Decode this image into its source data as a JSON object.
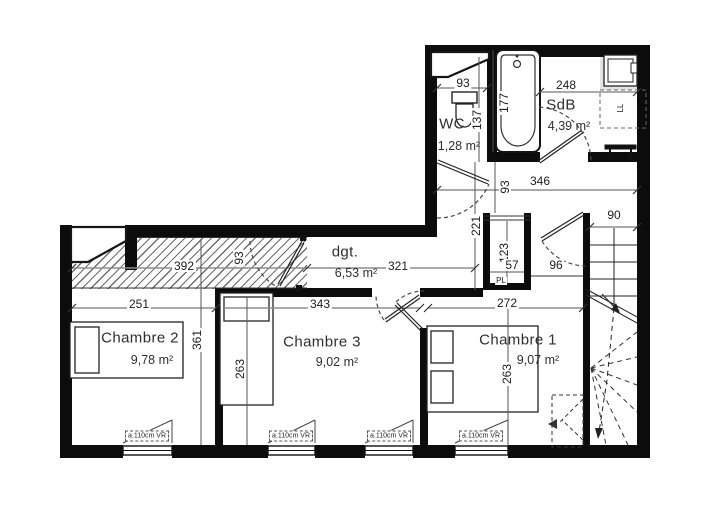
{
  "plan": {
    "rooms": [
      {
        "id": "wc",
        "name": "WC",
        "area": "1,28 m²"
      },
      {
        "id": "sdb",
        "name": "SdB",
        "area": "4,39 m²"
      },
      {
        "id": "dgt",
        "name": "dgt.",
        "area": "6,53 m²"
      },
      {
        "id": "chambre2",
        "name": "Chambre 2",
        "area": "9,78 m²"
      },
      {
        "id": "chambre3",
        "name": "Chambre 3",
        "area": "9,02 m²"
      },
      {
        "id": "chambre1",
        "name": "Chambre 1",
        "area": "9,07 m²"
      }
    ],
    "closet_label": "PL",
    "appliance_label": "LL",
    "window_label": "a.110cm VR",
    "dims": {
      "wc_width": "93",
      "wc_depth": "137",
      "bath_length": "177",
      "sdb_width": "248",
      "hall_length": "346",
      "hall_width": "93",
      "stair_width": "90",
      "stair_door_width": "96",
      "dgt_depth": "221",
      "closet_depth": "123",
      "closet_width": "57",
      "ch2_total_width": "392",
      "ch2_door_width": "93",
      "dgt_length": "321",
      "ch2_width": "251",
      "ch3_width": "343",
      "ch1_width": "272",
      "ch2_depth": "361",
      "ch3_depth": "263",
      "ch1_depth": "263"
    },
    "colors": {
      "wall": "#0c0c0c",
      "line": "#2e2e2e",
      "dim_line": "#8d8d8d"
    }
  }
}
